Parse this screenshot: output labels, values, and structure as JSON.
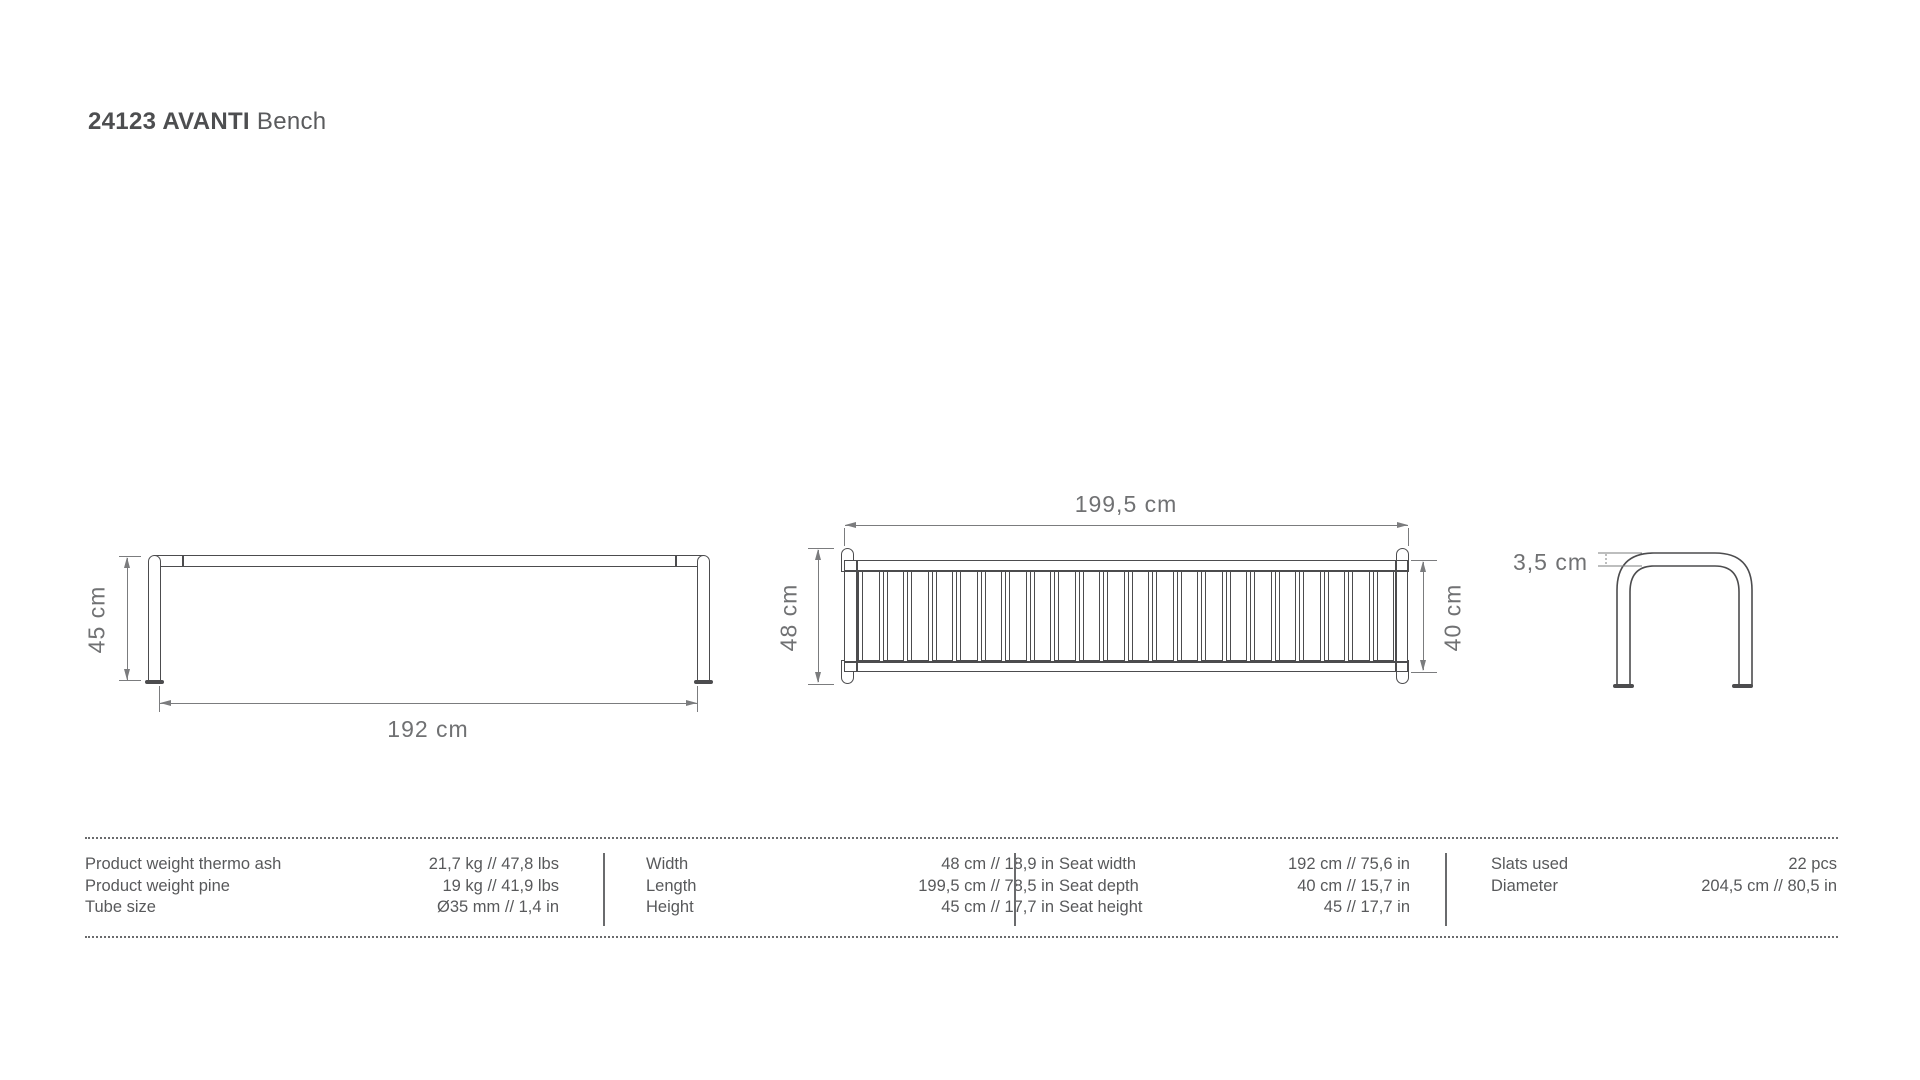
{
  "title": {
    "code": "24123 AVANTI",
    "name": "Bench"
  },
  "drawings": {
    "front_view": {
      "height_dim": "45 cm",
      "width_dim": "192 cm"
    },
    "top_view": {
      "length_dim": "199,5 cm",
      "overall_depth_dim": "48 cm",
      "seat_depth_dim": "40 cm",
      "slat_count": 22
    },
    "side_view": {
      "tube_diameter_dim": "3,5 cm"
    }
  },
  "spec_table": {
    "groups": [
      {
        "rows": [
          {
            "label": "Product weight thermo ash",
            "value": "21,7 kg // 47,8 lbs"
          },
          {
            "label": "Product weight pine",
            "value": "19 kg // 41,9 lbs"
          },
          {
            "label": "Tube size",
            "value": "Ø35 mm // 1,4 in"
          }
        ]
      },
      {
        "rows": [
          {
            "label": "Width",
            "value": "48 cm // 18,9 in"
          },
          {
            "label": "Length",
            "value": "199,5 cm // 78,5 in"
          },
          {
            "label": "Height",
            "value": "45 cm // 17,7 in"
          }
        ]
      },
      {
        "rows": [
          {
            "label": "Seat width",
            "value": "192 cm // 75,6 in"
          },
          {
            "label": "Seat depth",
            "value": "40 cm // 15,7 in"
          },
          {
            "label": "Seat height",
            "value": "45 // 17,7 in"
          }
        ]
      },
      {
        "rows": [
          {
            "label": "Slats used",
            "value": "22 pcs"
          },
          {
            "label": "Diameter",
            "value": "204,5 cm // 80,5 in"
          }
        ]
      }
    ]
  },
  "colors": {
    "drawing_line": "#4c4c4e",
    "dimension_line": "#7b7c7e",
    "text": "#58595b"
  }
}
